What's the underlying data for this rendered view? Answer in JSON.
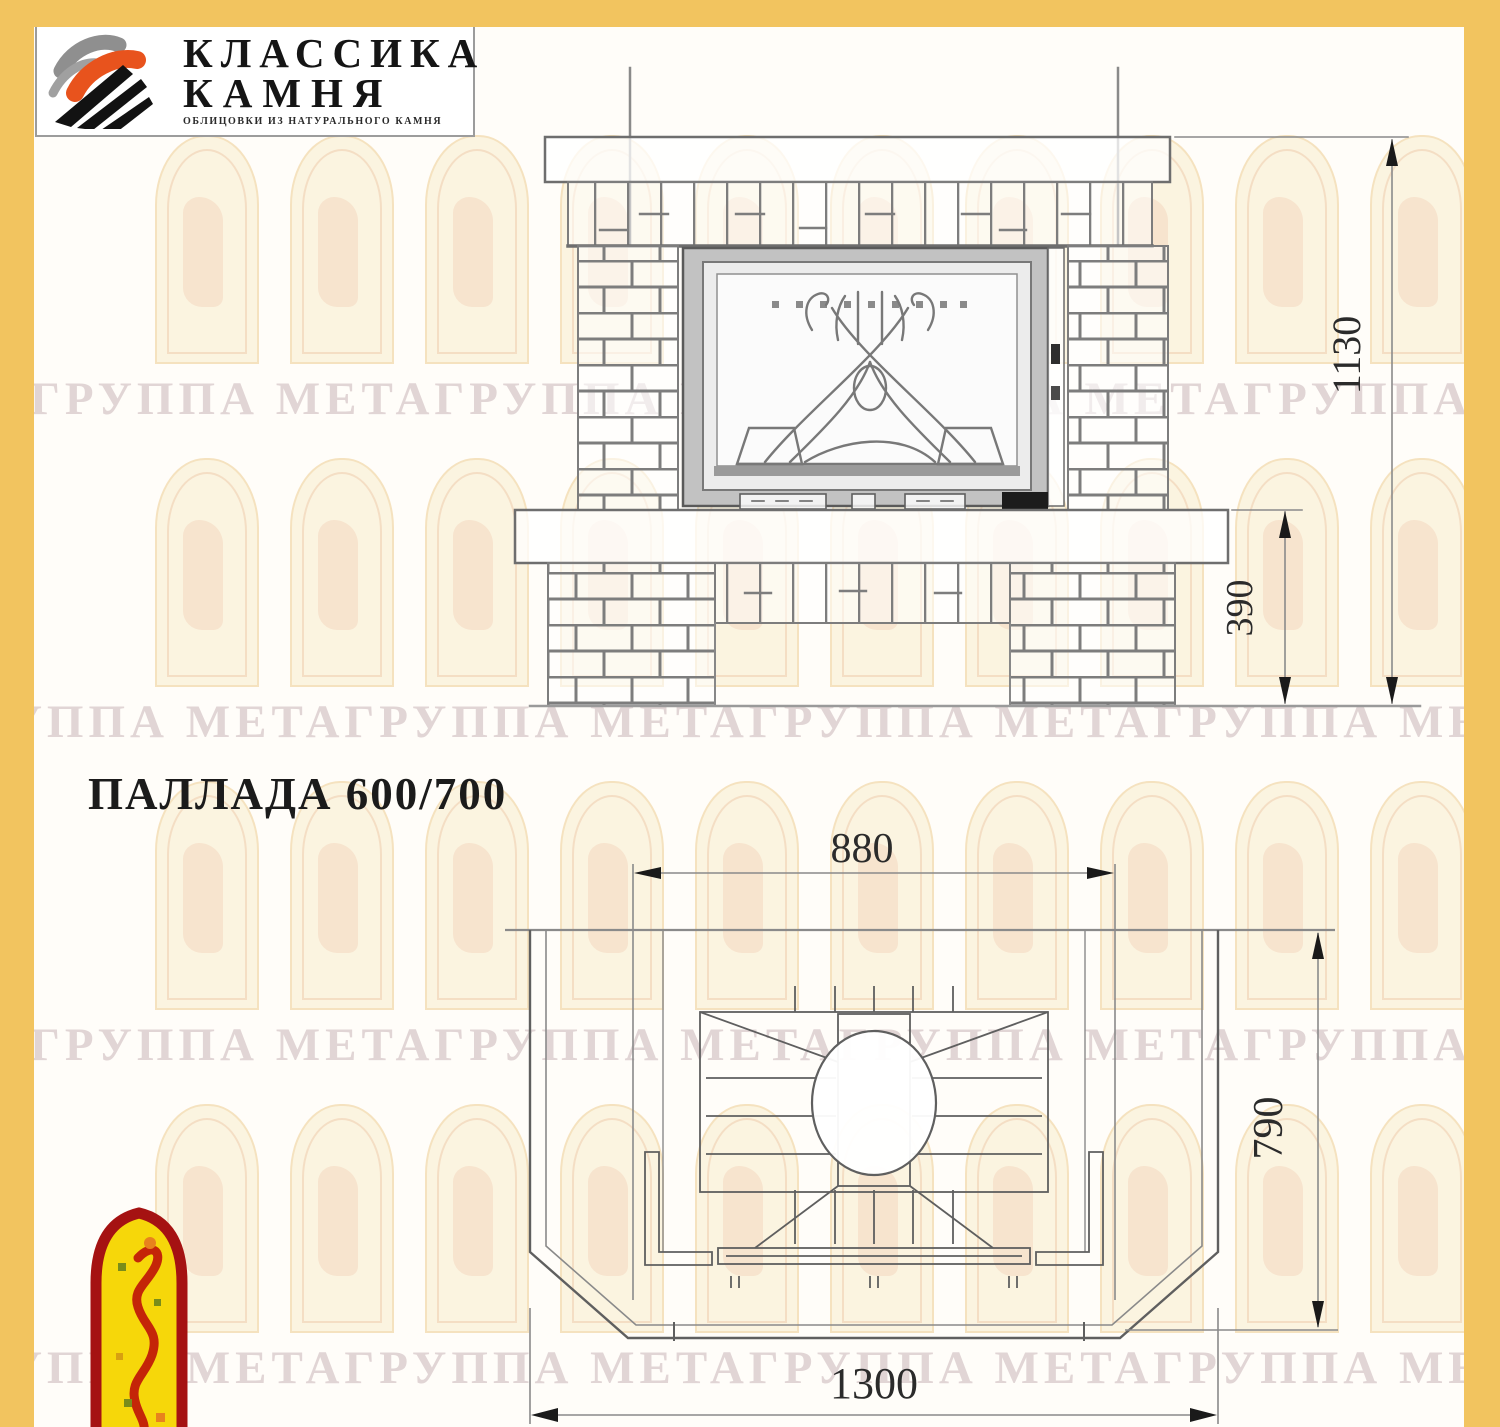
{
  "brand": {
    "line1": "КЛАССИКА",
    "line2": "КАМНЯ",
    "tagline": "ОБЛИЦОВКИ ИЗ НАТУРАЛЬНОГО КАМНЯ"
  },
  "title": "ПАЛЛАДА 600/700",
  "watermark_text": "ГРУППА МЕТАГРУППА МЕТАГРУППА МЕТАГРУППА МЕТА",
  "front_view": {
    "label_total_height": "1130",
    "label_hearth_height": "390"
  },
  "plan_view": {
    "label_inner_width": "880",
    "label_depth": "790",
    "label_total_width": "1300"
  },
  "colors": {
    "frame_yellow": "#f2c45f",
    "logo_orange": "#e8531d",
    "emblem_red": "#a51212",
    "emblem_yellow": "#f6d70a",
    "watermark": "#c9b4b8"
  }
}
